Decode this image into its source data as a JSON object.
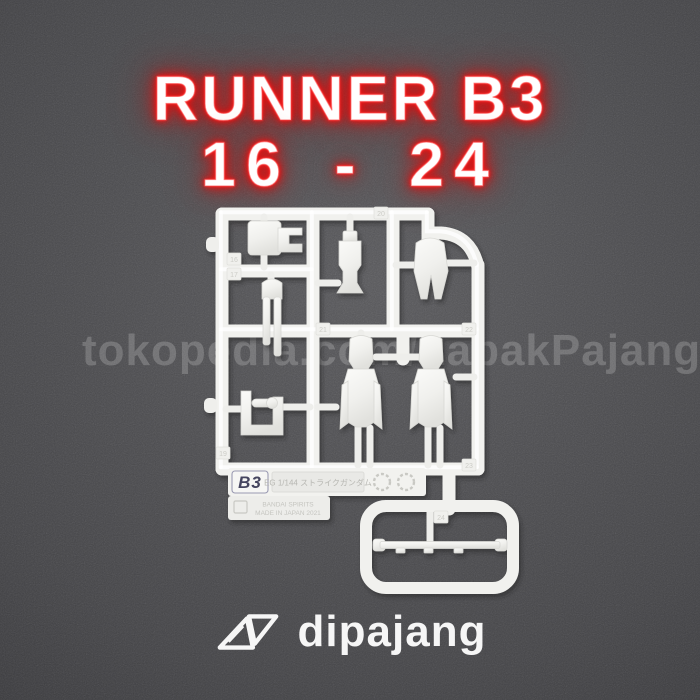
{
  "background": {
    "base_color": "#4b4b4e",
    "vignette_color": "#38383b"
  },
  "title": {
    "line1": "RUNNER B3",
    "line2": "16 - 24",
    "text_color": "#ffffff",
    "glow_color": "#e81414"
  },
  "watermark": {
    "text": "tokopedia.com/LapakPajang"
  },
  "runner": {
    "plastic_color": "#f1f1ee",
    "label": {
      "code": "B3",
      "kit_text": "EG 1/144 ストライクガンダム",
      "maker_line1": "BANDAI SPIRITS",
      "maker_line2": "MADE IN JAPAN 2021"
    },
    "part_tags": {
      "t16": "16",
      "t17": "17",
      "t19": "19",
      "t20": "20",
      "t21": "21",
      "t22": "22",
      "t23": "23",
      "t24": "24"
    }
  },
  "logo": {
    "text": "dipajang",
    "color": "#f6f6f6"
  },
  "icons": {
    "logo_mark": "dipajang-twin-triangles",
    "material_marks": "plastic-recycle-circles"
  }
}
